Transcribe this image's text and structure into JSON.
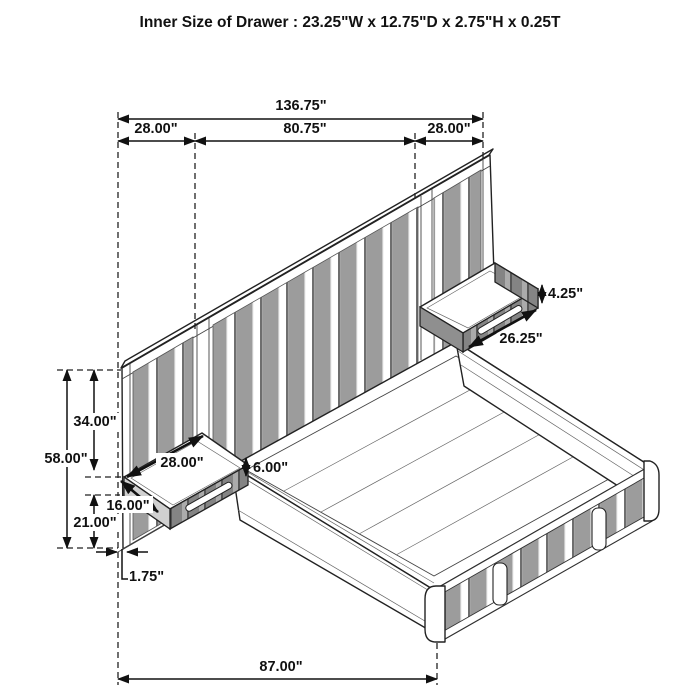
{
  "title": "Inner Size of Drawer : 23.25\"W x 12.75\"D x 2.75\"H x 0.25T",
  "dims": {
    "total_width": "136.75\"",
    "section_left": "28.00\"",
    "section_middle": "80.75\"",
    "section_right": "28.00\"",
    "panel_upper_height": "34.00\"",
    "panel_total_height": "58.00\"",
    "panel_lower_height": "21.00\"",
    "panel_thickness": "1.75\"",
    "nightstand_width": "28.00\"",
    "nightstand_depth": "16.00\"",
    "rail_height": "6.00\"",
    "shelf_height": "4.25\"",
    "shelf_front": "26.25\"",
    "bed_length": "87.00\""
  },
  "colors": {
    "line": "#1a1a1a",
    "panel_gray": "#9c9c9c",
    "panel_dark": "#868686",
    "side_light": "#d0d0d0",
    "background": "#ffffff"
  }
}
